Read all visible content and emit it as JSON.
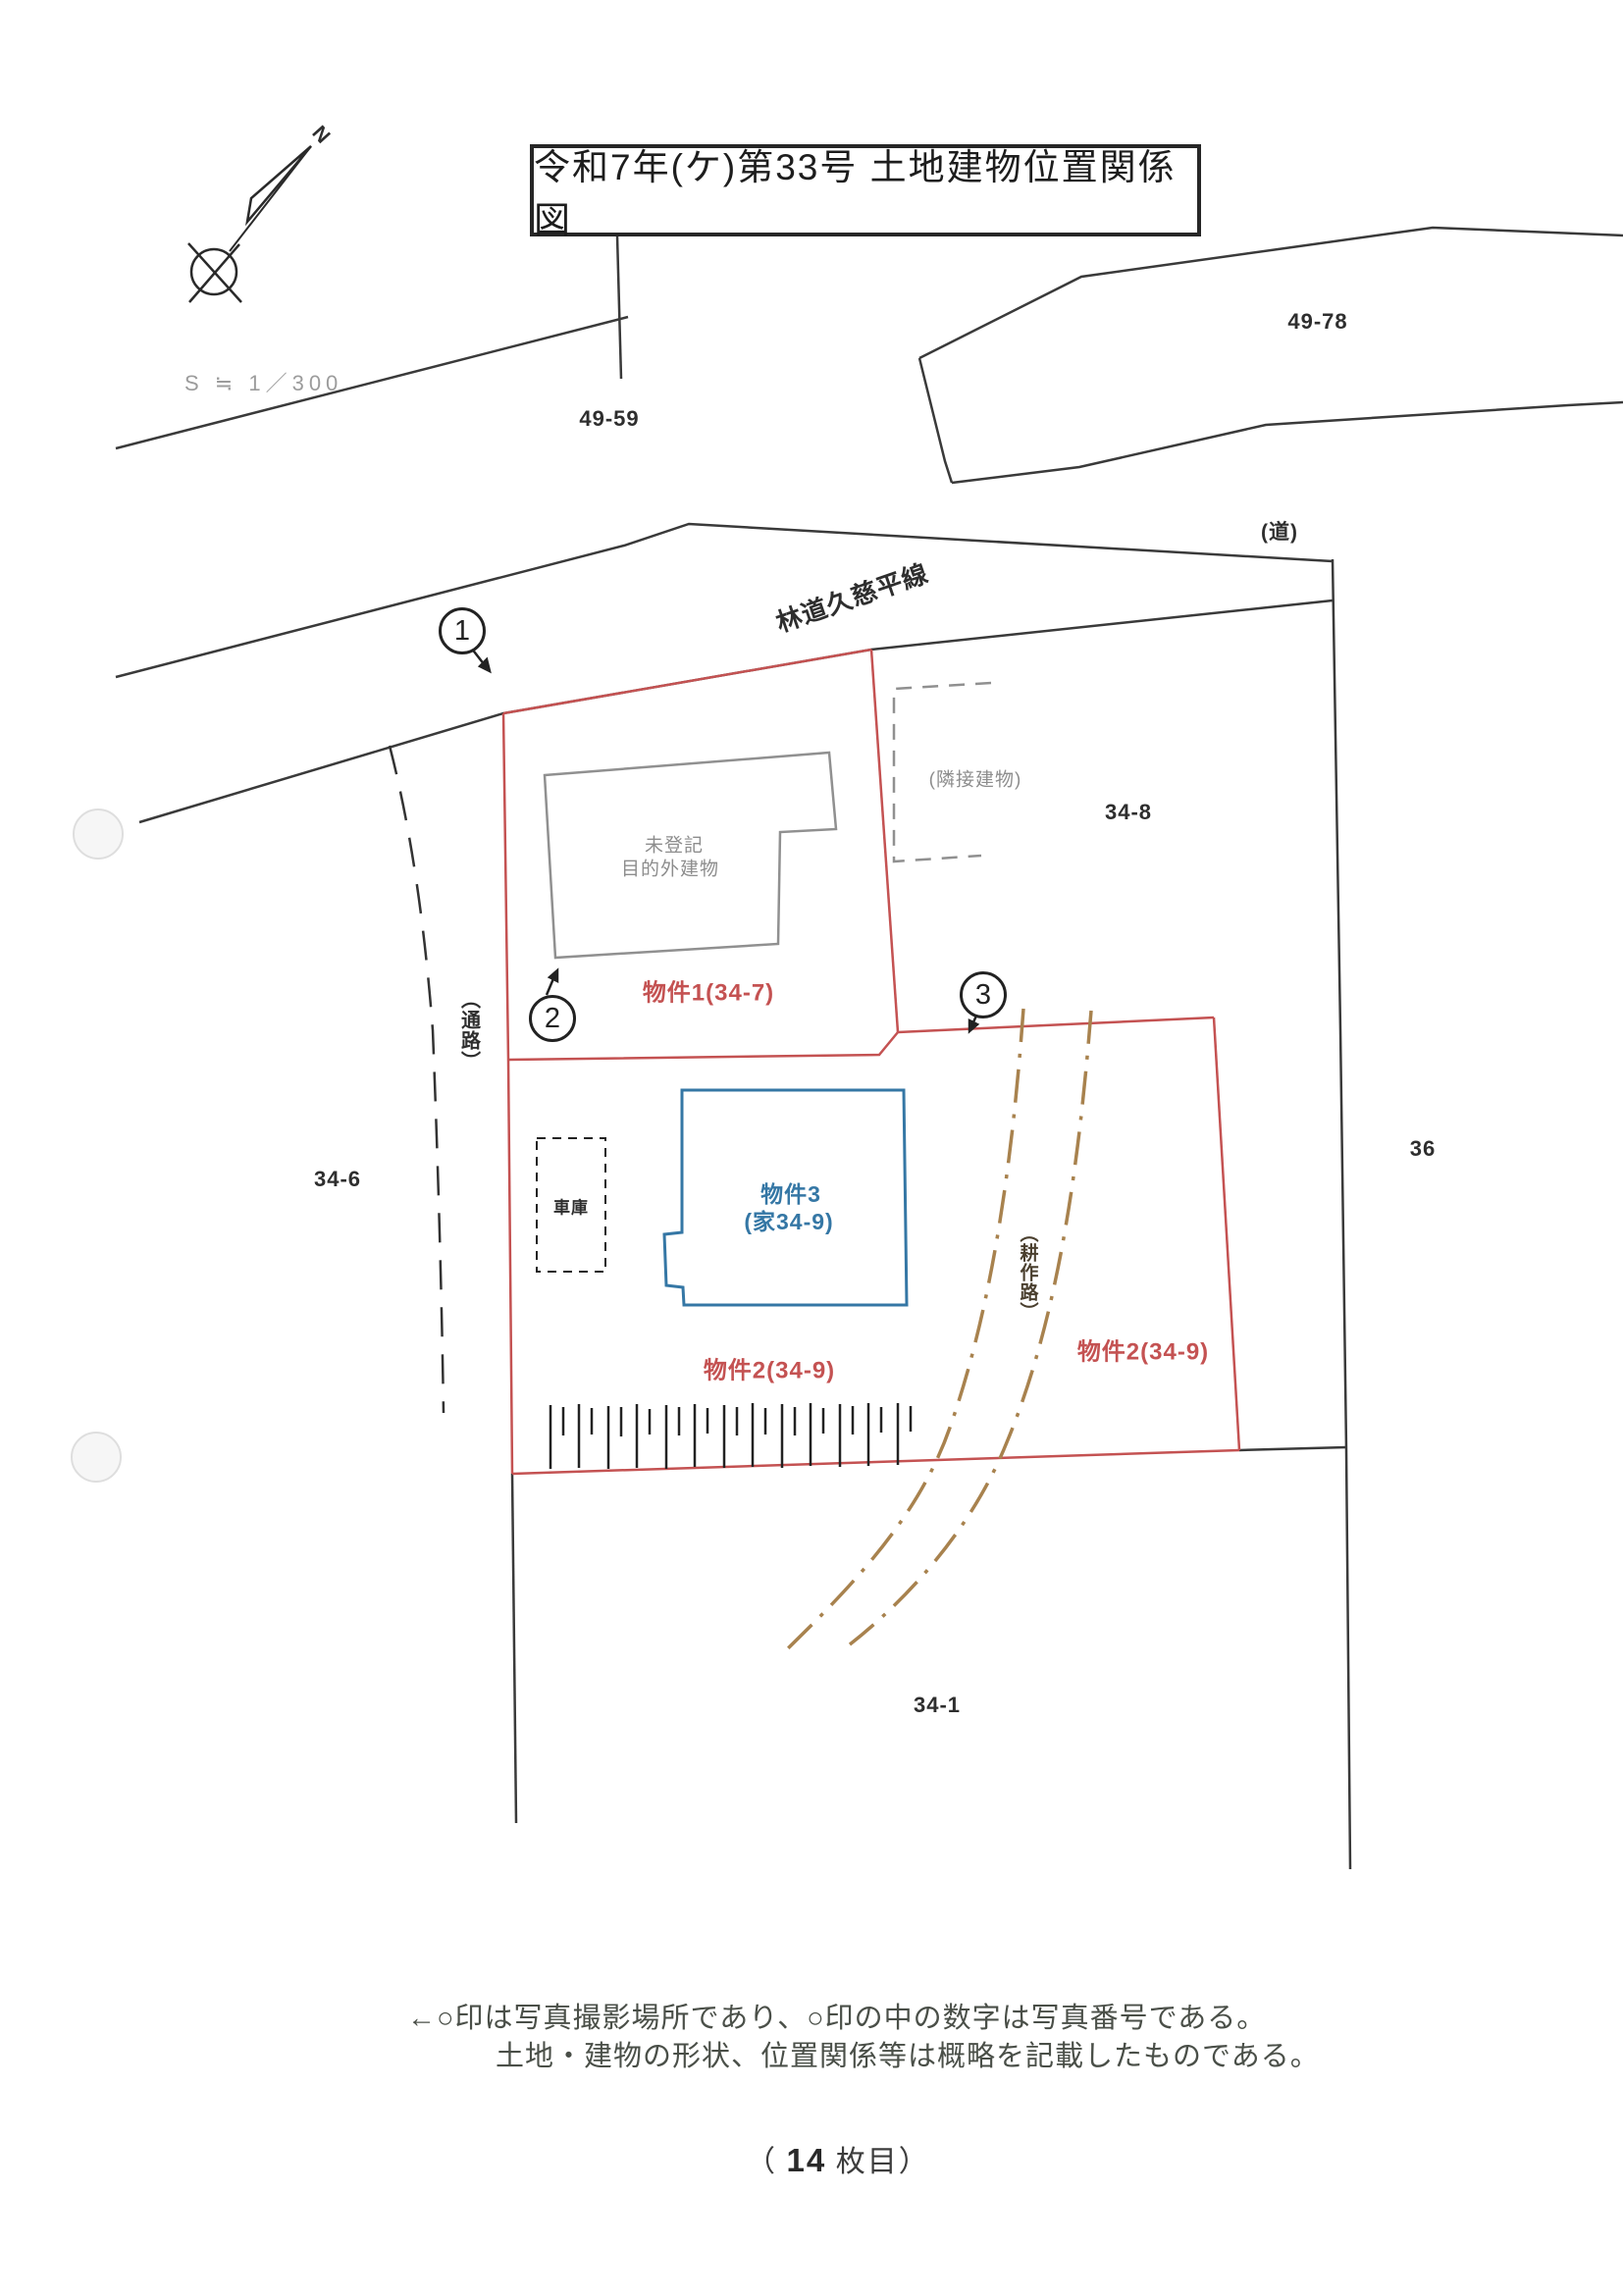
{
  "title": "令和7年(ケ)第33号 土地建物位置関係図",
  "scale_label": "S ≒ 1／300",
  "north_label": "N",
  "labels": {
    "road_name": "林道久慈平線",
    "parcel_49_59": "49-59",
    "parcel_49_78": "49-78",
    "road_paren": "(道)",
    "parcel_34_8": "34-8",
    "parcel_36": "36",
    "parcel_34_6": "34-6",
    "parcel_34_1": "34-1",
    "bukken1": "物件1(34-7)",
    "bukken2_left": "物件2(34-9)",
    "bukken2_right": "物件2(34-9)",
    "bukken3_line1": "物件3",
    "bukken3_line2": "(家34-9)",
    "unregistered_line1": "未登記",
    "unregistered_line2": "目的外建物",
    "adjacent_building": "(隣接建物)",
    "garage": "車庫",
    "passage": "（通路）",
    "farm_path": "（耕作路）"
  },
  "photo_markers": [
    {
      "number": "1"
    },
    {
      "number": "2"
    },
    {
      "number": "3"
    }
  ],
  "notes": {
    "line1": "←○印は写真撮影場所であり、○印の中の数字は写真番号である。",
    "line2": "土地・建物の形状、位置関係等は概略を記載したものである。"
  },
  "page_label": {
    "open": "（",
    "number": "14",
    "close": "枚目）"
  },
  "colors": {
    "parcel_outline_red": "#c45252",
    "building_blue": "#3577a5",
    "farm_path_brown": "#a8824e",
    "annotation_gray": "#8d8d8d",
    "line_black": "#3a3a3a"
  }
}
